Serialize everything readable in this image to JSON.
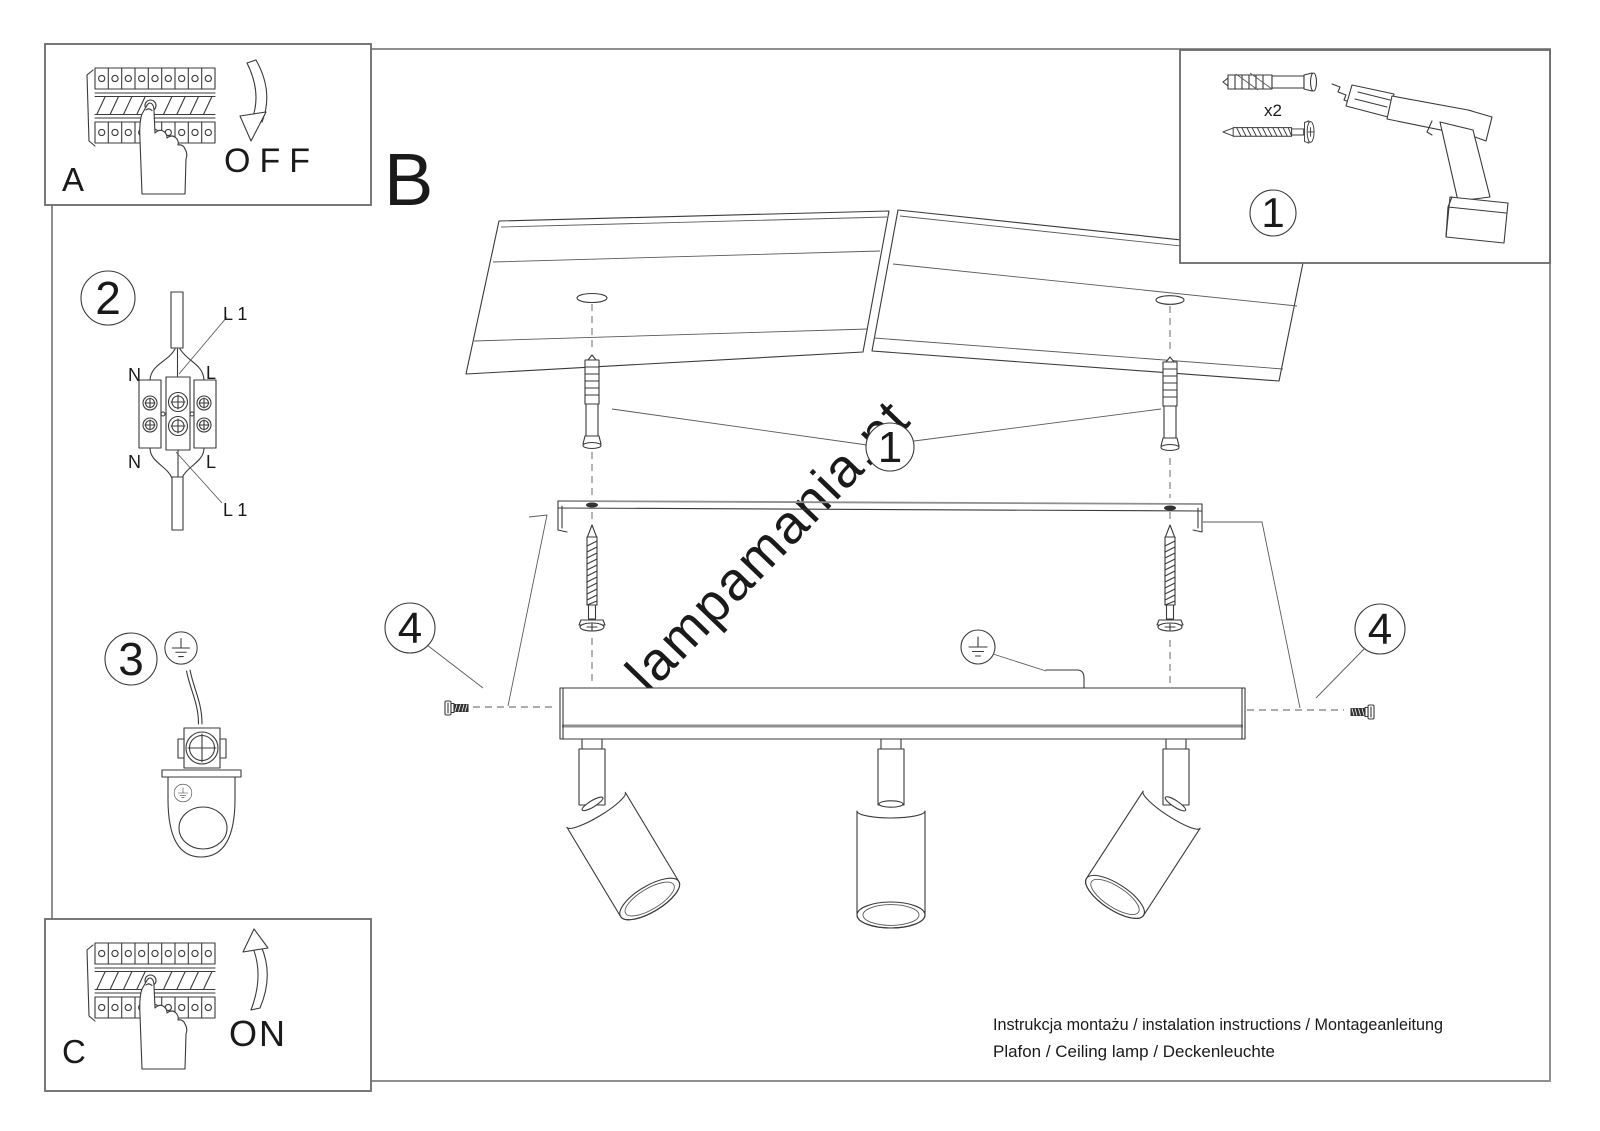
{
  "steps": {
    "a_label": "A",
    "b_label": "B",
    "c_label": "C",
    "off_label": "OFF",
    "on_label": "ON"
  },
  "callouts": {
    "n1": "1",
    "n2": "2",
    "n3": "3",
    "n4": "4"
  },
  "parts_box": {
    "plug_qty": "x2"
  },
  "wiring_labels": {
    "l1_top": "L 1",
    "n_top": "N",
    "l_top": "L",
    "n_bottom": "N",
    "l_bottom": "L",
    "l1_bottom": "L 1"
  },
  "watermark": {
    "text": "lampamania.pt",
    "color": "#c8cec3"
  },
  "footer": {
    "line1": "Instrukcja montażu / instalation instructions / Montageanleitung",
    "line2": "Plafon / Ceiling lamp / Deckenleuchte"
  },
  "colors": {
    "line": "#3a3a3a",
    "frame": "#8f8f8f",
    "box_frame": "#6a6a6a"
  }
}
